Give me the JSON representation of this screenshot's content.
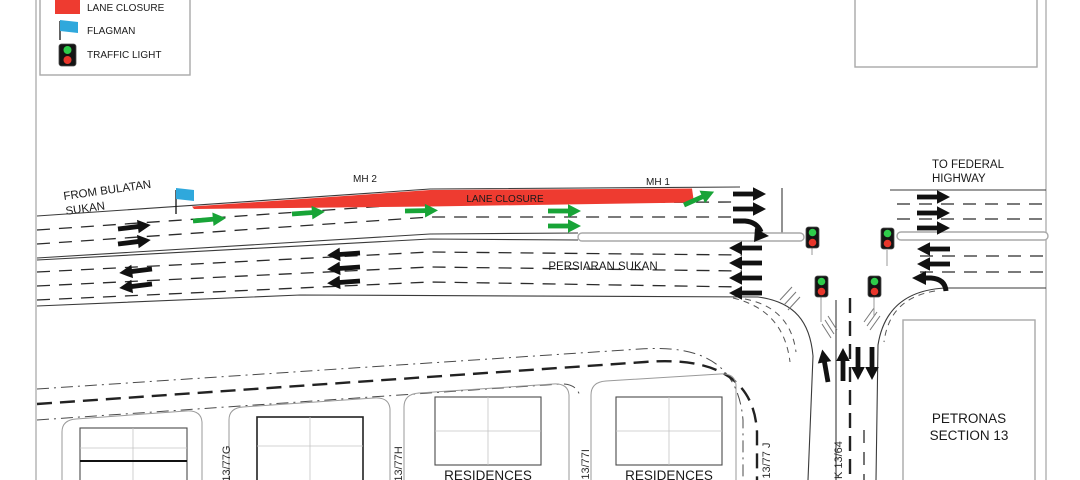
{
  "legend": {
    "items": [
      {
        "label": "LANE CLOSURE",
        "icon": "lane-closure-swatch"
      },
      {
        "label": "FLAGMAN",
        "icon": "flagman-flag"
      },
      {
        "label": "TRAFFIC LIGHT",
        "icon": "traffic-light"
      }
    ]
  },
  "annotations": {
    "from_road_line1": "FROM BULATAN",
    "from_road_line2": "SUKAN",
    "to_road_line1": "TO FEDERAL",
    "to_road_line2": "HIGHWAY",
    "main_road_name": "PERSIARAN SUKAN",
    "closure_label": "LANE CLOSURE",
    "manhole_1": "MH 1",
    "manhole_2": "MH 2"
  },
  "buildings": {
    "petronas_line1": "PETRONAS",
    "petronas_line2": "SECTION 13",
    "residences_a": "RESIDENCES",
    "residences_b": "RESIDENCES"
  },
  "streets": {
    "g": "K 13/77G",
    "h": "K 13/77H",
    "i": "K 13/77I",
    "j": "K 13/77 J",
    "k64": "K 13/64"
  },
  "colors": {
    "closure_red": "#ee3b30",
    "flag_blue": "#2fa8dc",
    "arrow_green": "#18a437",
    "signal_green": "#2ecc4a",
    "signal_red": "#e8362b"
  }
}
